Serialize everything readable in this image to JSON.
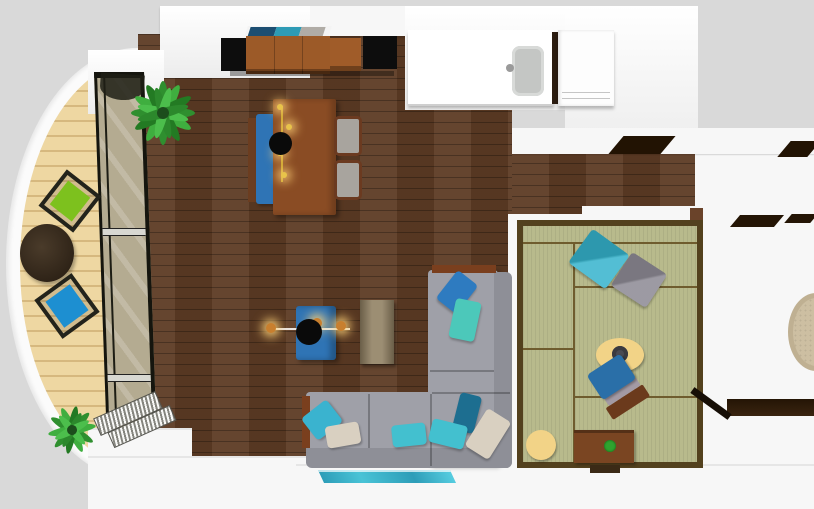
{
  "app": {
    "name": "3d-floor-plan-top-view",
    "view": "top-down render",
    "visible_text": "none"
  },
  "palette": {
    "bg": "#d9d9d9",
    "wall": "#f7f7f7",
    "wood": "#5d3b24",
    "deck": "#eed7a2",
    "tatami": "#b8ba8c",
    "tatamiborder": "#53411e",
    "tatamiline": "#6f5c2e",
    "sofa": "#9fa0a8",
    "sofaback": "#8e8f97",
    "woodtrim": "#7a3f1e",
    "blue": "#2f74b5",
    "teal": "#43c0cf",
    "darkteal": "#1d6e90",
    "beige": "#d9d0c1",
    "green": "#7dc11e",
    "bluechair": "#1d8fd1",
    "yellow": "#f2d387",
    "brown": "#8a4c24",
    "cabinet": "#9c5a28",
    "black": "#0d0d0d",
    "rugteal": "#38b1c8",
    "roundrug": "#cdbfa2",
    "glass": "#cfc29e",
    "plant": "#2f8f2f",
    "gold": "#c9a227",
    "gray": "#8f8c96",
    "sink": "#c4c6c4"
  },
  "rooms": [
    {
      "id": "living-dining",
      "label": "Living / dining room",
      "floor": "dark wood planks"
    },
    {
      "id": "kitchen",
      "label": "Kitchen with sink counter",
      "floor": "dark wood / white"
    },
    {
      "id": "balcony",
      "label": "Curved balcony",
      "floor": "light wood deck"
    },
    {
      "id": "tatami-room",
      "label": "Tatami room",
      "floor": "green tatami mats"
    },
    {
      "id": "hallway",
      "label": "Hallway",
      "floor": "dark wood planks"
    },
    {
      "id": "bedroom-right",
      "label": "Right room (partial)",
      "floor": "dark wood planks"
    }
  ],
  "furniture": [
    {
      "label": "Dining table",
      "color": "#8a4c24"
    },
    {
      "label": "Dining bench",
      "color": "#2f74b5"
    },
    {
      "label": "Dining chair",
      "color": "#a8a49e"
    },
    {
      "label": "Dining chair",
      "color": "#a8a49e"
    },
    {
      "label": "Pendant lamp over dining table",
      "color": "#0d0d0d"
    },
    {
      "label": "Sideboard with speakers and decor",
      "color": "#9c5a28"
    },
    {
      "label": "Kitchen counter with sink",
      "color": "#ffffff"
    },
    {
      "label": "Kitchen appliance",
      "color": "#ffffff"
    },
    {
      "label": "Blue coffee table",
      "color": "#2f74b5"
    },
    {
      "label": "String pendant light",
      "color": "#c9a227"
    },
    {
      "label": "Wooden bench table",
      "color": "#8e7e60"
    },
    {
      "label": "L-shaped gray sectional sofa with blue, teal and beige pillows",
      "color": "#9fa0a8"
    },
    {
      "label": "Teal runner rug",
      "color": "#38b1c8"
    },
    {
      "label": "Teal floor cushion",
      "color": "#35b3cc"
    },
    {
      "label": "Gray floor cushion",
      "color": "#8f8c96"
    },
    {
      "label": "Blue legless zaisu chair",
      "color": "#2a6fa8"
    },
    {
      "label": "Yellow oval cushion with dark center",
      "color": "#f2d387"
    },
    {
      "label": "Round yellow cushion",
      "color": "#f2d387"
    },
    {
      "label": "Low TV board with plant",
      "color": "#7a4522"
    },
    {
      "label": "Balcony round table",
      "color": "#3a2f22"
    },
    {
      "label": "Balcony chair green",
      "color": "#7dc11e"
    },
    {
      "label": "Balcony chair blue",
      "color": "#1d8fd1"
    },
    {
      "label": "Large palm plant",
      "color": "#2f8f2f"
    },
    {
      "label": "Small palm plant",
      "color": "#2f8f2f"
    },
    {
      "label": "Round beige rug",
      "color": "#cdbfa2"
    }
  ],
  "fixtures": [
    {
      "label": "Floor-to-ceiling window wall to balcony"
    },
    {
      "label": "Open louver window panels"
    },
    {
      "label": "Kitchen sink"
    },
    {
      "label": "Open interior doors (hallway)"
    },
    {
      "label": "Sliding door strip (tatami room)"
    }
  ]
}
